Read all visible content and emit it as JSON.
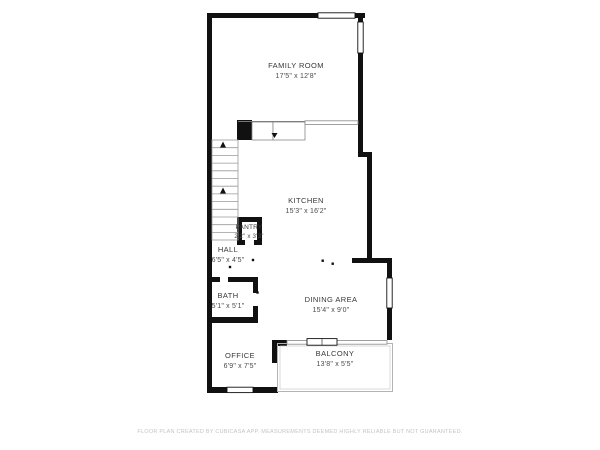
{
  "title": "Floor plan",
  "rooms": {
    "family_room": {
      "name": "FAMILY ROOM",
      "dims": "17'5\" x 12'8\""
    },
    "kitchen": {
      "name": "KITCHEN",
      "dims": "15'3\" x 16'2\""
    },
    "pantry": {
      "name": "PANTRY",
      "dims": "2'2\" x 3'3\""
    },
    "hall": {
      "name": "HALL",
      "dims": "6'5\" x 4'5\""
    },
    "bath": {
      "name": "BATH",
      "dims": "5'1\" x 5'1\""
    },
    "dining_area": {
      "name": "DINING AREA",
      "dims": "15'4\" x 9'0\""
    },
    "office": {
      "name": "OFFICE",
      "dims": "6'9\" x 7'5\""
    },
    "balcony": {
      "name": "BALCONY",
      "dims": "13'8\" x 5'5\""
    }
  },
  "footer": {
    "disclaimer": "FLOOR PLAN CREATED BY CUBICASA APP. MEASUREMENTS DEEMED HIGHLY RELIABLE BUT NOT GUARANTEED."
  },
  "colors": {
    "wall": "#111111",
    "room_text": "#3d3d3d",
    "disclaimer_text": "#c4c4c4",
    "background": "#ffffff"
  }
}
